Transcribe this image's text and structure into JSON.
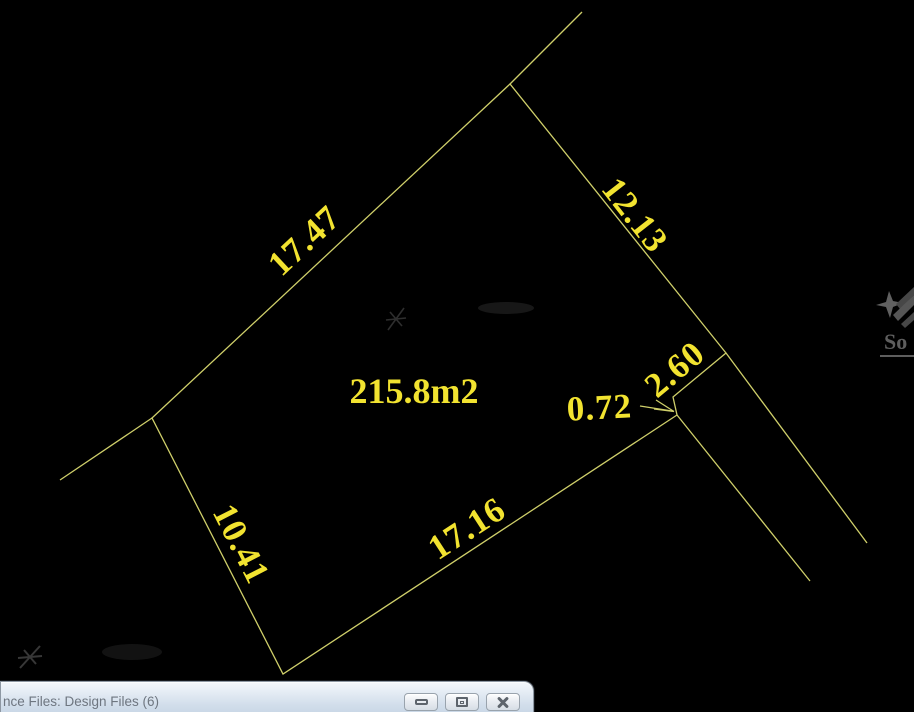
{
  "drawing": {
    "area_label": "215.8m2",
    "dim_17_47": "17.47",
    "dim_12_13": "12.13",
    "dim_2_60": "2.60",
    "dim_0_72": "0.72",
    "dim_10_41": "10.41",
    "dim_17_16": "17.16",
    "colors": {
      "background": "#000000",
      "boundary_line": "#cfcf6a",
      "dimension_text": "#f2e330"
    }
  },
  "watermark": {
    "logo_text": "So"
  },
  "window_bar": {
    "title": "nce Files: Design Files (6)",
    "title_color": "#6e7680",
    "buttons": [
      {
        "name": "minimize"
      },
      {
        "name": "restore-down"
      },
      {
        "name": "close"
      }
    ]
  }
}
